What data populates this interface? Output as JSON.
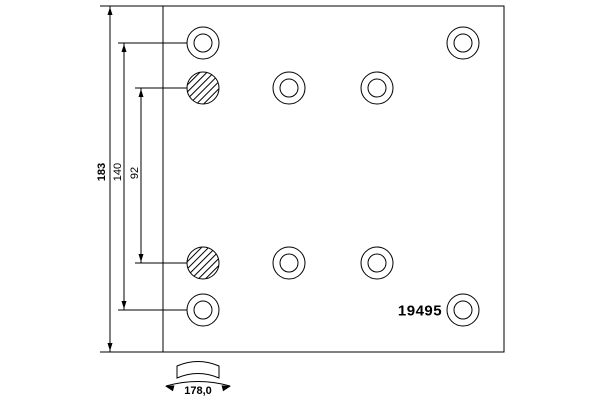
{
  "part": {
    "number": "19495"
  },
  "dimensions": {
    "height_total": "183",
    "hole_spacing_outer": "140",
    "hole_spacing_inner": "92",
    "arc_width": "178,0"
  },
  "colors": {
    "line": "#000000",
    "background": "#ffffff"
  },
  "holes": {
    "outer_radius": 16,
    "inner_radius": 9,
    "items": [
      {
        "cx": 203,
        "cy": 43,
        "type": "plain"
      },
      {
        "cx": 463,
        "cy": 43,
        "type": "plain"
      },
      {
        "cx": 203,
        "cy": 88,
        "type": "hatched"
      },
      {
        "cx": 289,
        "cy": 88,
        "type": "plain"
      },
      {
        "cx": 377,
        "cy": 88,
        "type": "plain"
      },
      {
        "cx": 203,
        "cy": 263,
        "type": "hatched"
      },
      {
        "cx": 289,
        "cy": 263,
        "type": "plain"
      },
      {
        "cx": 377,
        "cy": 263,
        "type": "plain"
      },
      {
        "cx": 203,
        "cy": 310,
        "type": "plain"
      },
      {
        "cx": 463,
        "cy": 310,
        "type": "plain"
      }
    ]
  }
}
